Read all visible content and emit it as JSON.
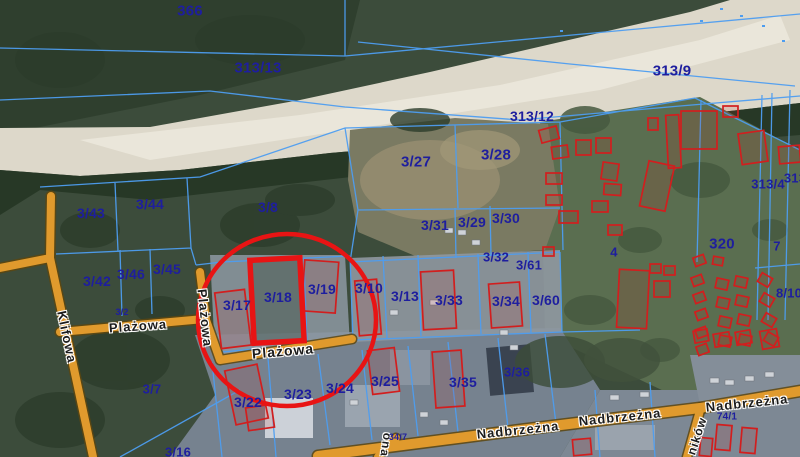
{
  "map": {
    "type": "cadastral-parcel-map-over-aerial-photo",
    "colors": {
      "boundary": "#4d9df0",
      "parcel_label": "#1e1e9e",
      "building": "#d21e1e",
      "road_fill": "#e09a2d",
      "road_casing": "#5d470f",
      "highlight": "#e81414",
      "street_label": "#1c1c1c"
    },
    "highlight": {
      "parcel": "3/18",
      "circle": {
        "cx": 287,
        "cy": 320,
        "rx": 89,
        "ry": 86
      },
      "rect": {
        "x": 252,
        "y": 259,
        "w": 50,
        "h": 83,
        "rot": -3
      }
    },
    "parcel_labels": [
      {
        "text": "366",
        "x": 190,
        "y": 11,
        "fs": 15
      },
      {
        "text": "313/13",
        "x": 258,
        "y": 68,
        "fs": 15
      },
      {
        "text": "313/9",
        "x": 672,
        "y": 71,
        "fs": 15
      },
      {
        "text": "313/12",
        "x": 532,
        "y": 116,
        "fs": 14
      },
      {
        "text": "3/27",
        "x": 416,
        "y": 162,
        "fs": 15
      },
      {
        "text": "3/28",
        "x": 496,
        "y": 155,
        "fs": 15
      },
      {
        "text": "3/8",
        "x": 268,
        "y": 207,
        "fs": 14
      },
      {
        "text": "3/44",
        "x": 150,
        "y": 204,
        "fs": 14
      },
      {
        "text": "3/43",
        "x": 91,
        "y": 213,
        "fs": 14
      },
      {
        "text": "3/42",
        "x": 97,
        "y": 281,
        "fs": 14
      },
      {
        "text": "3/46",
        "x": 131,
        "y": 274,
        "fs": 14
      },
      {
        "text": "3/45",
        "x": 167,
        "y": 269,
        "fs": 14
      },
      {
        "text": "3/31",
        "x": 435,
        "y": 225,
        "fs": 14
      },
      {
        "text": "3/29",
        "x": 472,
        "y": 222,
        "fs": 14
      },
      {
        "text": "3/30",
        "x": 506,
        "y": 218,
        "fs": 14
      },
      {
        "text": "3/32",
        "x": 496,
        "y": 257,
        "fs": 13
      },
      {
        "text": "3/61",
        "x": 529,
        "y": 265,
        "fs": 13
      },
      {
        "text": "3/17",
        "x": 237,
        "y": 305,
        "fs": 14
      },
      {
        "text": "3/18",
        "x": 278,
        "y": 297,
        "fs": 14
      },
      {
        "text": "3/19",
        "x": 322,
        "y": 289,
        "fs": 14
      },
      {
        "text": "3/10",
        "x": 369,
        "y": 288,
        "fs": 14
      },
      {
        "text": "3/13",
        "x": 405,
        "y": 296,
        "fs": 14
      },
      {
        "text": "3/33",
        "x": 449,
        "y": 300,
        "fs": 14
      },
      {
        "text": "3/34",
        "x": 506,
        "y": 301,
        "fs": 14
      },
      {
        "text": "3/60",
        "x": 546,
        "y": 300,
        "fs": 14
      },
      {
        "text": "320",
        "x": 722,
        "y": 244,
        "fs": 15
      },
      {
        "text": "4",
        "x": 614,
        "y": 252,
        "fs": 13
      },
      {
        "text": "7",
        "x": 777,
        "y": 246,
        "fs": 13
      },
      {
        "text": "8/10",
        "x": 789,
        "y": 293,
        "fs": 13
      },
      {
        "text": "313/4",
        "x": 768,
        "y": 184,
        "fs": 13
      },
      {
        "text": "313",
        "x": 795,
        "y": 178,
        "fs": 13
      },
      {
        "text": "3/7",
        "x": 152,
        "y": 389,
        "fs": 13
      },
      {
        "text": "3/16",
        "x": 178,
        "y": 452,
        "fs": 13
      },
      {
        "text": "3/22",
        "x": 248,
        "y": 402,
        "fs": 14
      },
      {
        "text": "3/23",
        "x": 298,
        "y": 394,
        "fs": 14
      },
      {
        "text": "3/24",
        "x": 340,
        "y": 388,
        "fs": 14
      },
      {
        "text": "3/25",
        "x": 385,
        "y": 381,
        "fs": 14
      },
      {
        "text": "3/35",
        "x": 463,
        "y": 382,
        "fs": 14
      },
      {
        "text": "3/36",
        "x": 517,
        "y": 372,
        "fs": 13
      },
      {
        "text": "74/1",
        "x": 727,
        "y": 417,
        "fs": 10
      },
      {
        "text": "34/7",
        "x": 398,
        "y": 437,
        "fs": 9
      },
      {
        "text": "3/2",
        "x": 122,
        "y": 312,
        "fs": 9
      }
    ],
    "street_labels": [
      {
        "text": "Plażowa",
        "x": 138,
        "y": 326,
        "rot": -4,
        "fs": 13
      },
      {
        "text": "Plażowa",
        "x": 205,
        "y": 318,
        "rot": 84,
        "fs": 13
      },
      {
        "text": "Plażowa",
        "x": 283,
        "y": 351,
        "rot": -5,
        "fs": 14
      },
      {
        "text": "Klifowa",
        "x": 67,
        "y": 337,
        "rot": 78,
        "fs": 13
      },
      {
        "text": "Nadbrzeżna",
        "x": 518,
        "y": 430,
        "rot": -6,
        "fs": 13
      },
      {
        "text": "Nadbrzeżna",
        "x": 620,
        "y": 417,
        "rot": -6,
        "fs": 13
      },
      {
        "text": "Nadbrzeżna",
        "x": 747,
        "y": 403,
        "rot": -6,
        "fs": 13
      },
      {
        "text": "ników",
        "x": 697,
        "y": 436,
        "rot": -72,
        "fs": 12
      },
      {
        "text": "ona",
        "x": 386,
        "y": 445,
        "rot": 98,
        "fs": 12
      }
    ],
    "buildings": [
      [
        540,
        128,
        18,
        13,
        -15
      ],
      [
        552,
        146,
        16,
        12,
        -8
      ],
      [
        576,
        140,
        15,
        15,
        0
      ],
      [
        596,
        138,
        15,
        15,
        0
      ],
      [
        602,
        163,
        16,
        17,
        8
      ],
      [
        604,
        184,
        17,
        11,
        4
      ],
      [
        592,
        201,
        16,
        11,
        0
      ],
      [
        559,
        211,
        19,
        12,
        0
      ],
      [
        546,
        173,
        16,
        11,
        0
      ],
      [
        546,
        195,
        16,
        10,
        0
      ],
      [
        608,
        225,
        14,
        10,
        0
      ],
      [
        644,
        163,
        26,
        46,
        12
      ],
      [
        648,
        118,
        10,
        12,
        0
      ],
      [
        667,
        115,
        13,
        53,
        -3
      ],
      [
        681,
        111,
        36,
        38,
        0
      ],
      [
        740,
        132,
        26,
        31,
        -8
      ],
      [
        723,
        106,
        15,
        11,
        0
      ],
      [
        779,
        146,
        21,
        17,
        -5
      ],
      [
        543,
        247,
        11,
        9,
        0
      ],
      [
        618,
        270,
        30,
        58,
        3
      ],
      [
        650,
        264,
        11,
        9,
        0
      ],
      [
        664,
        266,
        11,
        9,
        0
      ],
      [
        654,
        281,
        16,
        16,
        0
      ],
      [
        694,
        256,
        11,
        9,
        -20
      ],
      [
        692,
        276,
        11,
        9,
        -20
      ],
      [
        694,
        293,
        11,
        9,
        -20
      ],
      [
        696,
        310,
        11,
        9,
        -20
      ],
      [
        696,
        328,
        11,
        9,
        -20
      ],
      [
        697,
        345,
        11,
        9,
        -20
      ],
      [
        713,
        257,
        10,
        8,
        10
      ],
      [
        716,
        279,
        12,
        10,
        12
      ],
      [
        717,
        298,
        12,
        10,
        12
      ],
      [
        719,
        317,
        12,
        10,
        12
      ],
      [
        719,
        336,
        12,
        10,
        12
      ],
      [
        735,
        277,
        12,
        10,
        12
      ],
      [
        736,
        296,
        12,
        10,
        12
      ],
      [
        738,
        315,
        12,
        10,
        12
      ],
      [
        739,
        335,
        12,
        10,
        12
      ],
      [
        759,
        275,
        12,
        10,
        30
      ],
      [
        761,
        295,
        12,
        10,
        30
      ],
      [
        763,
        315,
        12,
        10,
        30
      ],
      [
        765,
        334,
        12,
        10,
        30
      ],
      [
        694,
        330,
        14,
        12,
        -10
      ],
      [
        714,
        333,
        16,
        13,
        -10
      ],
      [
        736,
        331,
        15,
        13,
        -10
      ],
      [
        761,
        330,
        17,
        18,
        -10
      ],
      [
        716,
        425,
        15,
        25,
        5
      ],
      [
        741,
        428,
        15,
        25,
        5
      ],
      [
        700,
        438,
        12,
        18,
        5
      ],
      [
        573,
        439,
        18,
        16,
        -5
      ],
      [
        218,
        291,
        30,
        56,
        -7
      ],
      [
        303,
        261,
        34,
        51,
        4
      ],
      [
        357,
        280,
        22,
        55,
        -5
      ],
      [
        422,
        271,
        33,
        58,
        -3
      ],
      [
        490,
        283,
        31,
        44,
        -4
      ],
      [
        370,
        349,
        27,
        44,
        -7
      ],
      [
        434,
        351,
        29,
        56,
        -4
      ],
      [
        230,
        367,
        33,
        55,
        -12
      ],
      [
        247,
        406,
        26,
        23,
        -8
      ]
    ]
  }
}
